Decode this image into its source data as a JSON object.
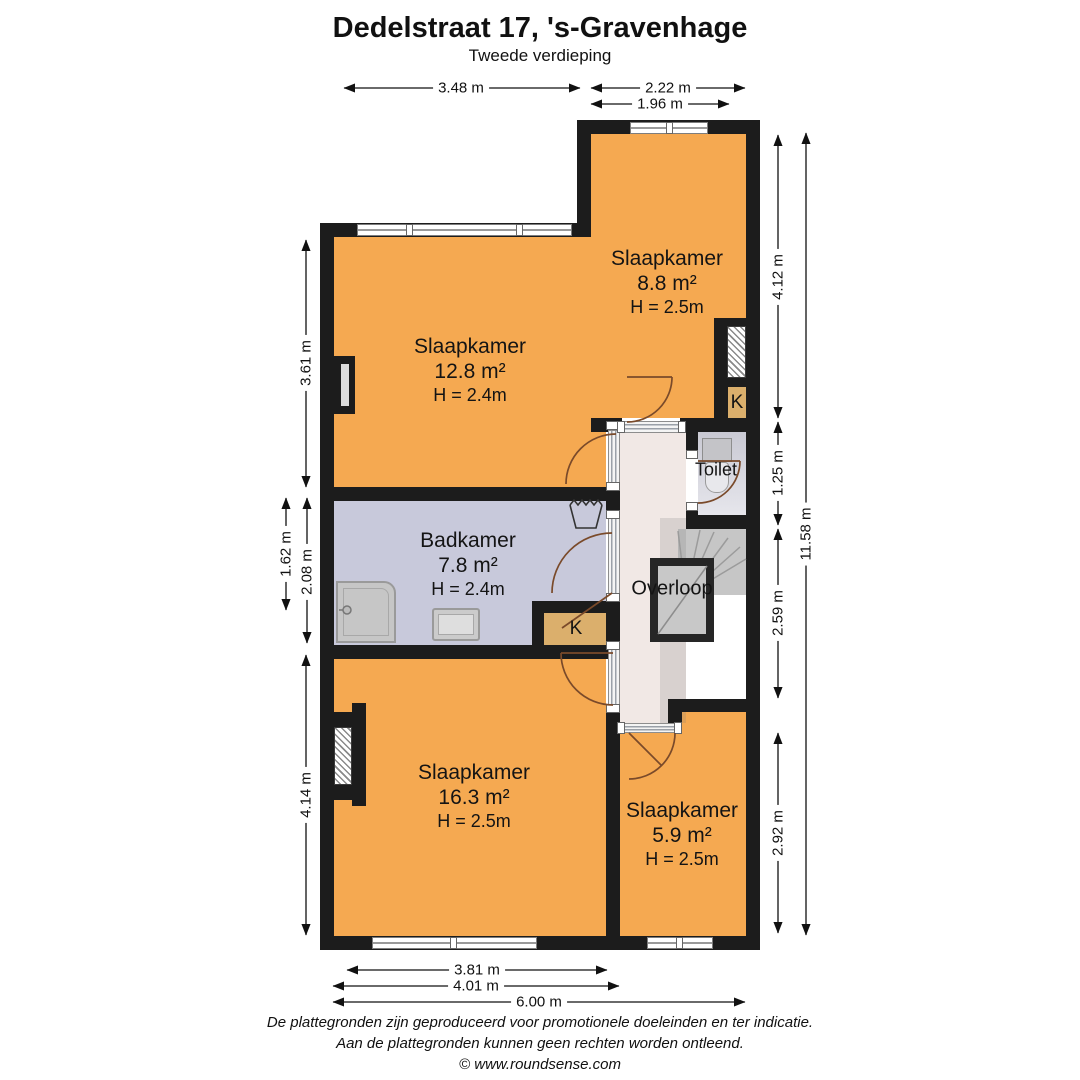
{
  "title": "Dedelstraat 17, 's-Gravenhage",
  "subtitle": "Tweede verdieping",
  "rooms": {
    "slaapkamer1": {
      "name": "Slaapkamer",
      "area": "12.8 m²",
      "height": "H = 2.4m"
    },
    "slaapkamer2": {
      "name": "Slaapkamer",
      "area": "8.8 m²",
      "height": "H = 2.5m"
    },
    "badkamer": {
      "name": "Badkamer",
      "area": "7.8 m²",
      "height": "H = 2.4m"
    },
    "toilet": {
      "name": "Toilet"
    },
    "overloop": {
      "name": "Overloop"
    },
    "slaapkamer3": {
      "name": "Slaapkamer",
      "area": "16.3 m²",
      "height": "H = 2.5m"
    },
    "slaapkamer4": {
      "name": "Slaapkamer",
      "area": "5.9 m²",
      "height": "H = 2.5m"
    },
    "closet_badkamer": {
      "name": "K"
    },
    "closet_slaapkamer2": {
      "name": "K"
    }
  },
  "dimensions": {
    "top": {
      "d1": "3.48 m",
      "d2": "2.22 m",
      "d3": "1.96 m"
    },
    "bottom": {
      "d1": "3.81 m",
      "d2": "4.01 m",
      "d3": "6.00 m"
    },
    "left": {
      "d1": "3.61 m",
      "d2": "1.62 m",
      "d3": "2.08 m",
      "d4": "4.14 m"
    },
    "right": {
      "d1": "4.12 m",
      "d2": "1.25 m",
      "d3": "2.59 m",
      "d4": "2.92 m",
      "d5": "11.58 m"
    }
  },
  "footer": {
    "line1": "De plattegronden zijn geproduceerd voor promotionele doeleinden en ter indicatie.",
    "line2": "Aan de plattegronden kunnen geen rechten worden ontleend.",
    "copyright": "© www.roundsense.com"
  },
  "colors": {
    "room_orange": "#F5A951",
    "bathroom_lavender": "#C8C9DB",
    "hall_pink": "#F1E8E5",
    "closet_tan": "#DBAF6C",
    "stair_gray": "#C6C6C6",
    "wall_black": "#1C1C1C"
  }
}
